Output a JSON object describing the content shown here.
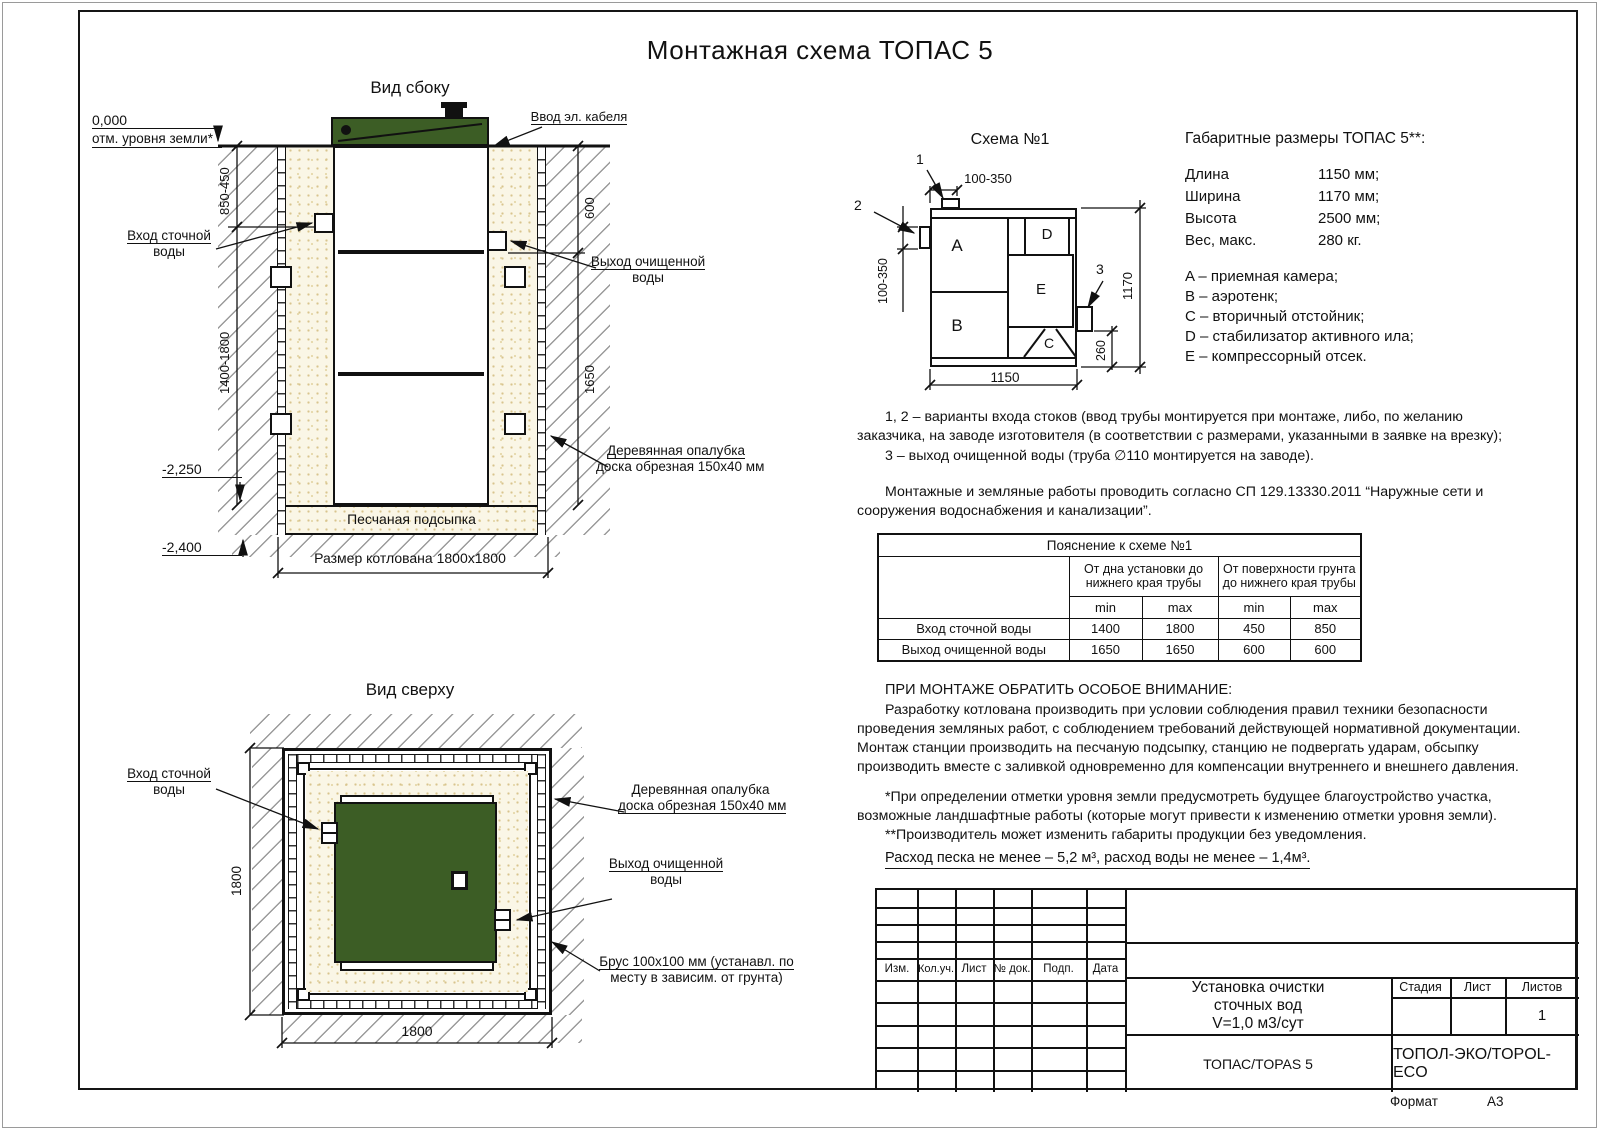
{
  "title": "Монтажная схема ТОПАС 5",
  "colors": {
    "lid_green": "#3c5d25",
    "line": "#111111",
    "sand": "#faf6e6"
  },
  "side_view": {
    "title": "Вид сбоку",
    "labels": {
      "zero_mark": "0,000",
      "ground_level": "отм. уровня земли*",
      "cable_entry": "Ввод эл. кабеля",
      "inlet_line1": "Вход сточной",
      "inlet_line2": "воды",
      "outlet_line1": "Выход очищенной",
      "outlet_line2": "воды",
      "formwork_line1": "Деревянная опалубка",
      "formwork_line2": "доска обрезная 150x40 мм",
      "sand_bed": "Песчаная подсыпка",
      "pit_size": "Размер котлована 1800x1800",
      "level_2250": "-2,250",
      "level_2400": "-2,400",
      "dim_depth_top": "850-450",
      "dim_depth_bottom": "1400-1800",
      "dim_outlet_top": "600",
      "dim_outlet_bottom": "1650"
    }
  },
  "top_view": {
    "title": "Вид сверху",
    "labels": {
      "inlet_line1": "Вход сточной",
      "inlet_line2": "воды",
      "formwork_line1": "Деревянная опалубка",
      "formwork_line2": "доска обрезная 150x40 мм",
      "outlet_line1": "Выход очищенной",
      "outlet_line2": "воды",
      "brus_line1": "Брус 100x100 мм (устанавл. по",
      "brus_line2": "месту в зависим. от грунта)",
      "dim_vertical": "1800",
      "dim_horizontal": "1800"
    }
  },
  "schema": {
    "title": "Схема №1",
    "compartments": {
      "a": "A",
      "b": "B",
      "c": "C",
      "d": "D",
      "e": "E"
    },
    "callouts": {
      "c1": "1",
      "c2": "2",
      "c3": "3"
    },
    "dims": {
      "top": "100-350",
      "left": "100-350",
      "right": "1170",
      "outlet": "260",
      "bottom": "1150"
    }
  },
  "dimensions": {
    "heading": "Габаритные размеры ТОПАС 5**:",
    "rows": [
      {
        "label": "Длина",
        "value": "1150 мм;"
      },
      {
        "label": "Ширина",
        "value": "1170 мм;"
      },
      {
        "label": "Высота",
        "value": "2500 мм;"
      },
      {
        "label": "Вес, макс.",
        "value": "280 кг."
      }
    ],
    "legend": [
      "A – приемная камера;",
      "B – аэротенк;",
      "C – вторичный отстойник;",
      "D – стабилизатор активного ила;",
      "E – компрессорный отсек."
    ]
  },
  "notes": {
    "variants_1": "1, 2 – варианты входа  стоков (ввод трубы монтируется при монтаже, либо, по желанию заказчика, на заводе изготовителя (в соответствии с размерами, указанными в заявке на врезку);",
    "variants_2": "3 – выход очищенной воды (труба ∅110 монтируется на заводе).",
    "sp": "Монтажные и земляные работы проводить согласно СП 129.13330.2011 “Наружные сети и сооружения водоснабжения и канализации”.",
    "attention_title": "ПРИ МОНТАЖЕ ОБРАТИТЬ ОСОБОЕ ВНИМАНИЕ:",
    "attention_body": "Разработку котлована производить при условии соблюдения правил техники безопасности проведения земляных работ, с соблюдением требований действующей нормативной документации. Монтаж станции производить на песчаную подсыпку, станцию не подвергать ударам, обсыпку производить вместе с заливкой одновременно для компенсации внутреннего и внешнего давления.",
    "footnote1": "*При определении отметки уровня земли предусмотреть будущее благоустройство участка, возможные ландшафтные работы (которые могут привести к изменению отметки уровня земли).",
    "footnote2": "**Производитель может изменить габариты продукции без уведомления.",
    "consumption": "Расход песка не менее – 5,2 м³, расход воды не менее – 1,4м³."
  },
  "table": {
    "title": "Пояснение к схеме №1",
    "col_group1": "От дна установки до нижнего края трубы",
    "col_group2": "От поверхности грунта до нижнего края трубы",
    "min_label": "min",
    "max_label": "max",
    "rows": [
      {
        "label": "Вход сточной воды",
        "v1": "1400",
        "v2": "1800",
        "v3": "450",
        "v4": "850"
      },
      {
        "label": "Выход очищенной воды",
        "v1": "1650",
        "v2": "1650",
        "v3": "600",
        "v4": "600"
      }
    ]
  },
  "stamp": {
    "cols": [
      "Изм.",
      "Кол.уч.",
      "Лист",
      "№ док.",
      "Подп.",
      "Дата"
    ],
    "doc_title_1": "Установка очистки",
    "doc_title_2": "сточных вод",
    "doc_title_3": "V=1,0 м3/сут",
    "stage_label": "Стадия",
    "sheet_label": "Лист",
    "sheets_label": "Листов",
    "sheets_value": "1",
    "product": "ТОПАС/TOPAS 5",
    "company": "ТОПОЛ-ЭКО/TOPOL-ECO",
    "format_label": "Формат",
    "format_value": "А3"
  }
}
